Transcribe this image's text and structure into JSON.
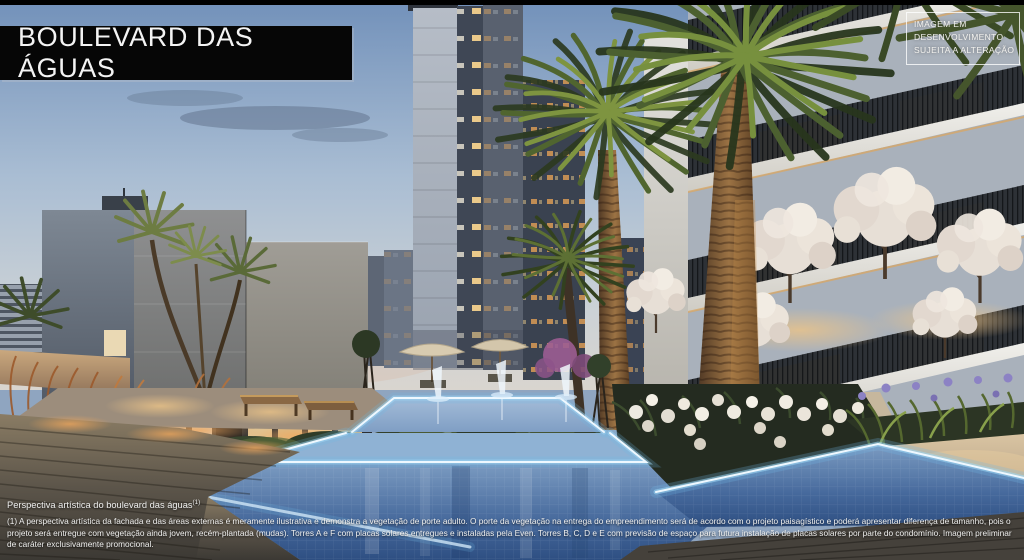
{
  "banner": {
    "title": "BOULEVARD DAS ÁGUAS"
  },
  "badge": {
    "lines": [
      "IMAGEM EM",
      "DESENVOLVIMENTO",
      "SUJEITA A ALTERAÇÃO"
    ]
  },
  "caption": {
    "title": "Perspectiva artística do boulevard das águas",
    "superscript": "(1)",
    "body": "(1) A perspectiva artística da fachada e das áreas externas é meramente ilustrativa e demonstra a vegetação de porte adulto. O porte da vegetação na entrega do empreendimento será de acordo com o projeto paisagístico e poderá apresentar diferença de tamanho, pois o projeto será entregue com vegetação ainda jovem, recém-plantada (mudas). Torres A e F com placas solares entregues e instaladas pela Even. Torres B, C, D e E com previsão de espaço para futura instalação de placas solares por parte do condomínio. Imagem preliminar de caráter exclusivamente promocional."
  },
  "theme": {
    "banner_bg": "#060606",
    "banner_text": "#f4f4f4",
    "sky_top": "#7291ba",
    "sky_horizon": "#d9d5cf",
    "pool_led_glow": "#9fd8f6",
    "pool_water_deep": "#2e4f82",
    "sunset_warm": "#d8a868"
  }
}
